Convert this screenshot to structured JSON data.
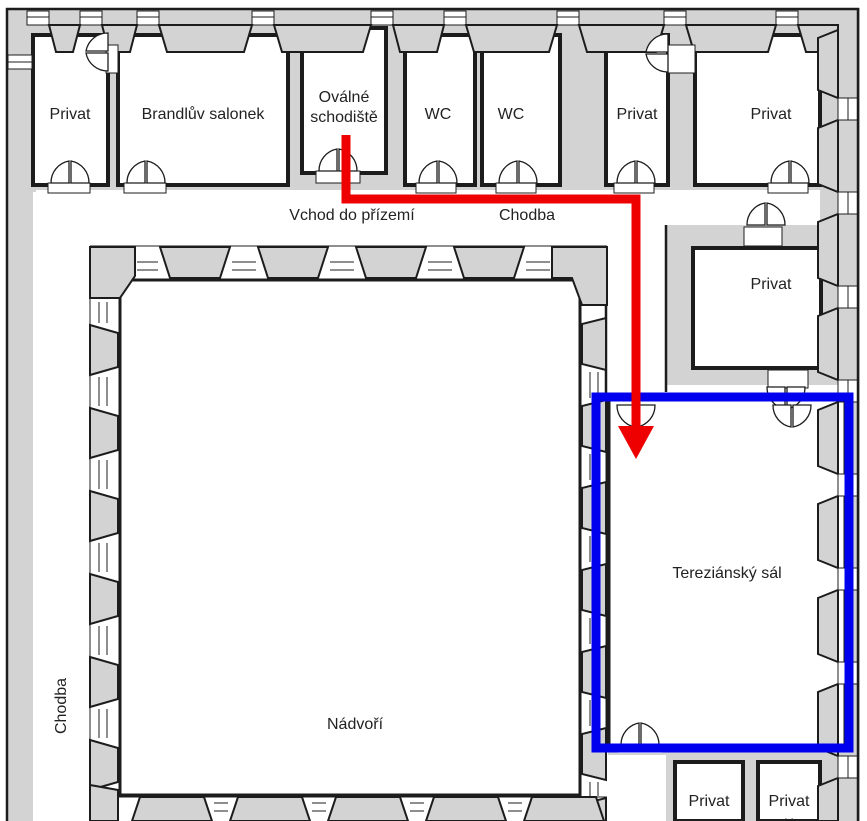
{
  "colors": {
    "wall": "#d3d3d3",
    "line": "#1c1c1c",
    "route": "#ee0000",
    "highlight": "#0000ee",
    "label": "#222222"
  },
  "rooms": {
    "privat_nw": {
      "label": "Privat"
    },
    "brandluv_salonek": {
      "label": "Brandlův salonek"
    },
    "ovalne_schodiste": {
      "label": "Oválné schodiště",
      "lines": [
        "Oválné",
        "schodiště"
      ]
    },
    "wc_1": {
      "label": "WC"
    },
    "wc_2": {
      "label": "WC"
    },
    "privat_n1": {
      "label": "Privat"
    },
    "privat_n2": {
      "label": "Privat"
    },
    "privat_e": {
      "label": "Privat"
    },
    "terezansky_sal": {
      "label": "Tereziánský sál"
    },
    "privat_s1": {
      "label": "Privat"
    },
    "privat_s2": {
      "label": "Privat",
      "cutoff": "( )"
    }
  },
  "areas": {
    "nadvori": {
      "label": "Nádvoří"
    }
  },
  "corridors": {
    "vchod": "Vchod do přízemí",
    "chodba_top": "Chodba",
    "chodba_left": "Chodba"
  }
}
